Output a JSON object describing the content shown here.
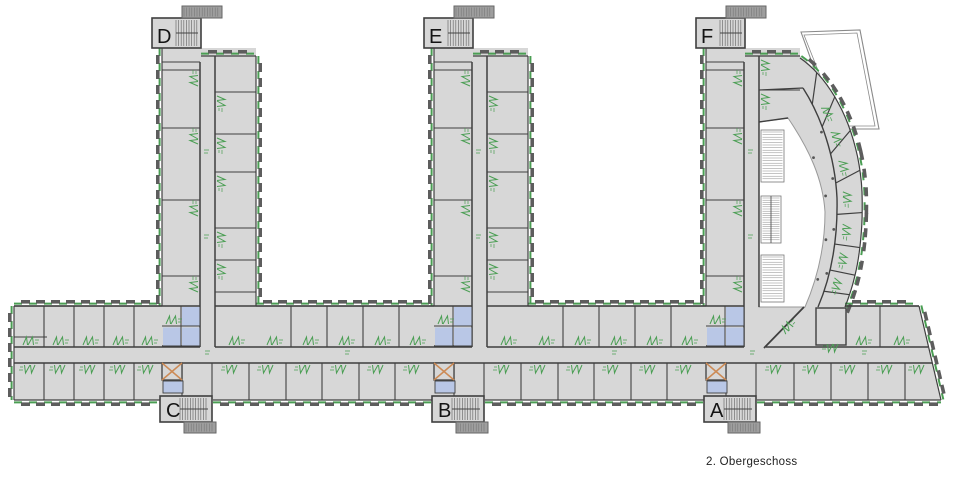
{
  "plan": {
    "title": "2. Obergeschoss",
    "towers": {
      "d": "D",
      "e": "E",
      "f": "F",
      "c": "C",
      "b": "B",
      "a": "A"
    }
  },
  "colors": {
    "background": "#ffffff",
    "room_fill": "#d7d7d7",
    "wall": "#3f3f3f",
    "wall_light": "#8f8f8f",
    "window_block": "#5d5d5d",
    "escape_green": "#4a9e53",
    "wc_blue": "#b9c7e6",
    "elevator_orange": "#cc8a55",
    "stair_hatch": "#6f6f6f",
    "annex_fill": "#9e9e9e",
    "label_text": "#141414"
  }
}
